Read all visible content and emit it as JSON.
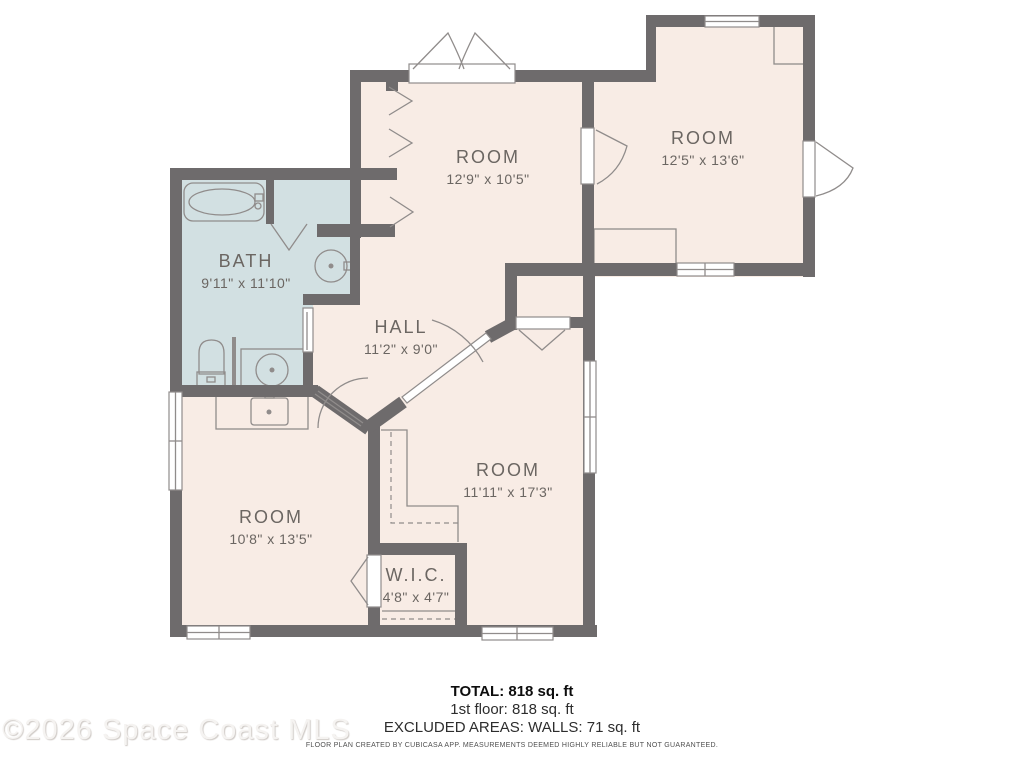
{
  "floorplan": {
    "rooms": [
      {
        "name": "ROOM",
        "dims": "12'9\" x 10'5\""
      },
      {
        "name": "ROOM",
        "dims": "12'5\" x 13'6\""
      },
      {
        "name": "BATH",
        "dims": "9'11\" x 11'10\""
      },
      {
        "name": "HALL",
        "dims": "11'2\" x 9'0\""
      },
      {
        "name": "ROOM",
        "dims": "11'11\" x 17'3\""
      },
      {
        "name": "ROOM",
        "dims": "10'8\" x 13'5\""
      },
      {
        "name": "W.I.C.",
        "dims": "4'8\" x 4'7\""
      }
    ],
    "summary": {
      "total": "TOTAL: 818 sq. ft",
      "floor": "1st floor: 818 sq. ft",
      "excluded": "EXCLUDED AREAS: WALLS: 71 sq. ft"
    },
    "disclaimer": "FLOOR PLAN CREATED BY CUBICASA APP. MEASUREMENTS DEEMED HIGHLY RELIABLE BUT NOT GUARANTEED.",
    "watermark": "©2026 Space Coast MLS",
    "colors": {
      "wall": "#6e6b6c",
      "floor": "#f8ece5",
      "bath": "#d2e0e2",
      "line": "#908c8b",
      "label": "#6b6662"
    }
  }
}
